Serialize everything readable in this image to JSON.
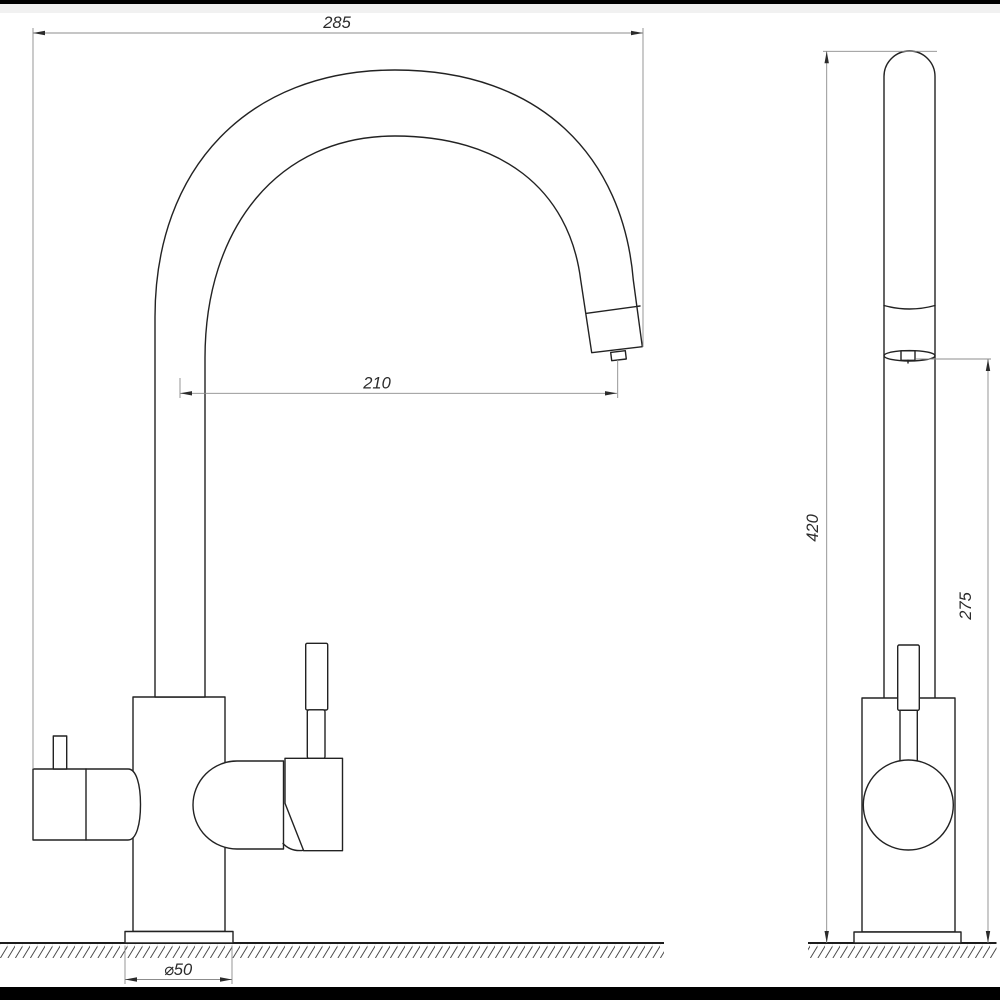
{
  "drawing": {
    "title": "kitchen-faucet-two-view-dimension-drawing",
    "dimensions": {
      "overall_width": "285",
      "spout_reach": "210",
      "total_height": "420",
      "spout_outlet_height": "275",
      "base_diameter": "⌀50"
    },
    "colors": {
      "outline": "#222222",
      "dimension_line": "#8c8c8c",
      "text": "#2b2b2b",
      "background": "#ffffff",
      "frame_bar": "#000000"
    }
  }
}
